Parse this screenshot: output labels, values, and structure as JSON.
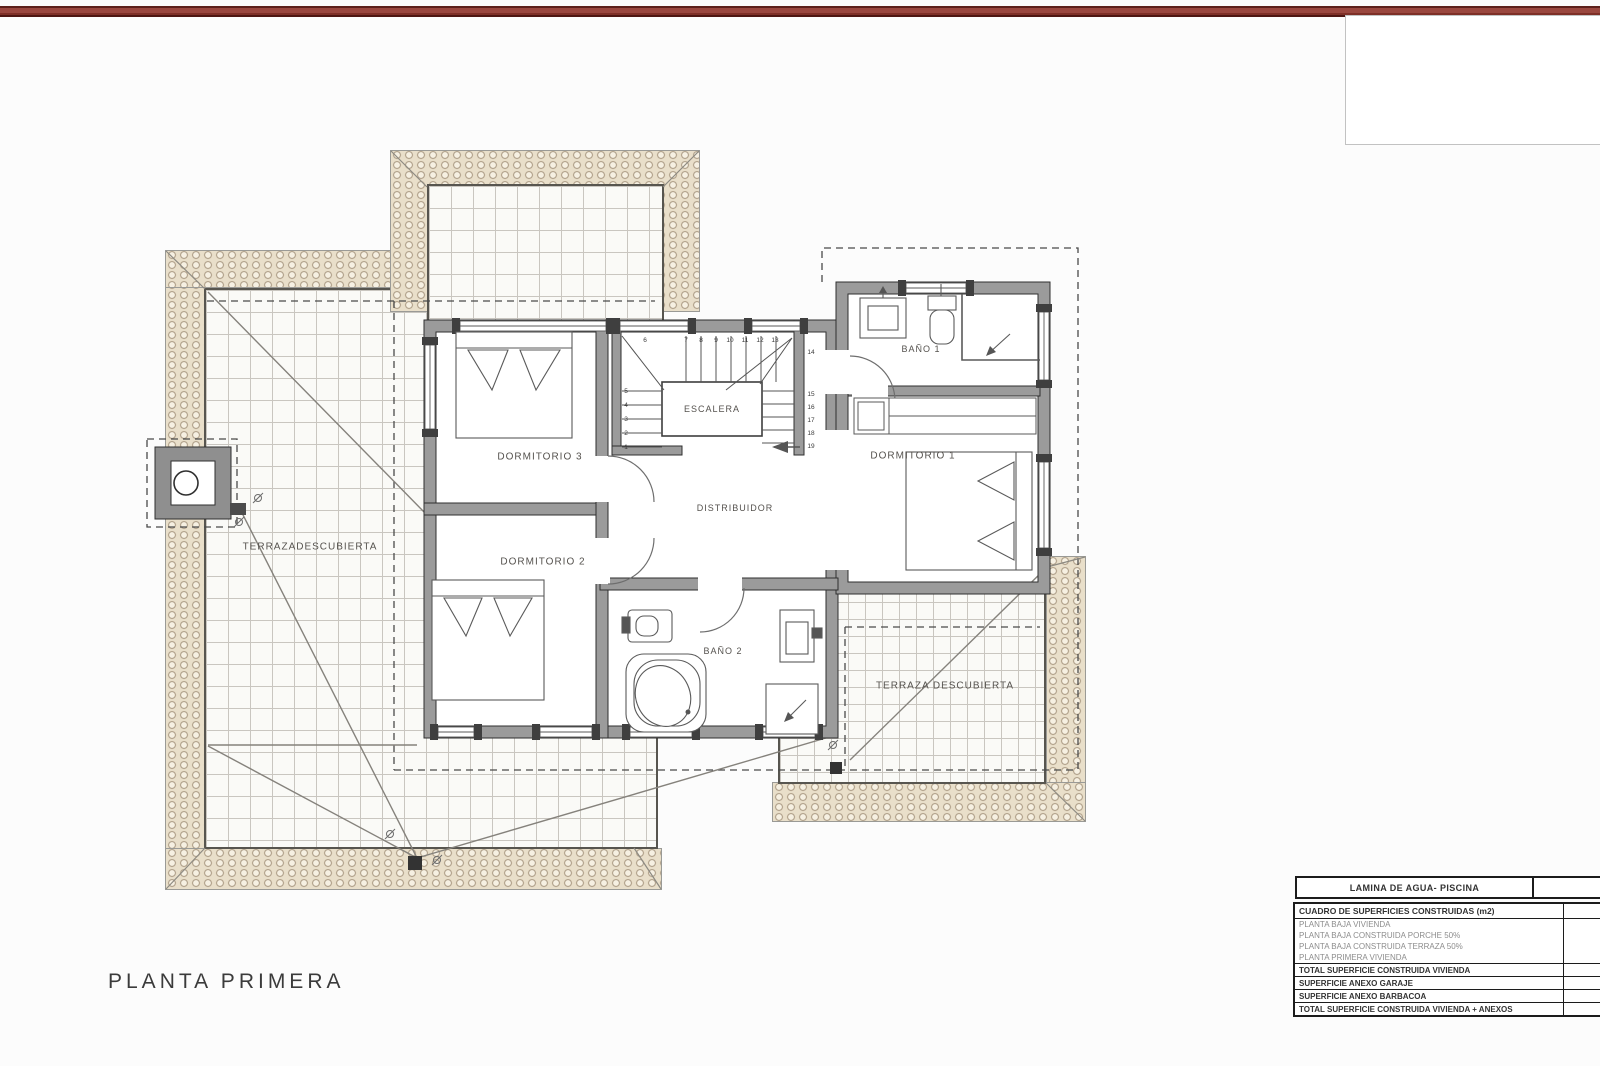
{
  "plan_title": "PLANTA PRIMERA",
  "rooms": {
    "dormitorio1": "DORMITORIO 1",
    "dormitorio2": "DORMITORIO 2",
    "dormitorio3": "DORMITORIO 3",
    "bano1": "BAÑO 1",
    "bano2": "BAÑO 2",
    "escalera": "ESCALERA",
    "distribuidor": "DISTRIBUIDOR",
    "terraza_izquierda": "TERRAZADESCUBIERTA",
    "terraza_derecha": "TERRAZA DESCUBIERTA"
  },
  "stairs": {
    "numbers": [
      {
        "n": "1",
        "x": 626,
        "y": 449
      },
      {
        "n": "2",
        "x": 626,
        "y": 435
      },
      {
        "n": "3",
        "x": 626,
        "y": 421
      },
      {
        "n": "4",
        "x": 626,
        "y": 407
      },
      {
        "n": "5",
        "x": 626,
        "y": 393
      },
      {
        "n": "6",
        "x": 645,
        "y": 342
      },
      {
        "n": "7",
        "x": 686,
        "y": 342
      },
      {
        "n": "8",
        "x": 701,
        "y": 342
      },
      {
        "n": "9",
        "x": 716,
        "y": 342
      },
      {
        "n": "10",
        "x": 730,
        "y": 342
      },
      {
        "n": "11",
        "x": 745,
        "y": 342
      },
      {
        "n": "12",
        "x": 760,
        "y": 342
      },
      {
        "n": "13",
        "x": 775,
        "y": 342
      },
      {
        "n": "14",
        "x": 811,
        "y": 354
      },
      {
        "n": "15",
        "x": 811,
        "y": 396
      },
      {
        "n": "16",
        "x": 811,
        "y": 409
      },
      {
        "n": "17",
        "x": 811,
        "y": 422
      },
      {
        "n": "18",
        "x": 811,
        "y": 435
      },
      {
        "n": "19",
        "x": 811,
        "y": 448
      }
    ]
  },
  "tables": {
    "lamina": {
      "title": "LAMINA DE AGUA- PISCINA",
      "value": ""
    },
    "cuadro": {
      "header": "CUADRO DE SUPERFICIES CONSTRUIDAS (m2)",
      "header_value": "",
      "rows": [
        {
          "label": "PLANTA BAJA VIVIENDA",
          "bold": false,
          "value": ""
        },
        {
          "label": "PLANTA BAJA CONSTRUIDA PORCHE 50%",
          "bold": false,
          "value": ""
        },
        {
          "label": "PLANTA BAJA CONSTRUIDA TERRAZA 50%",
          "bold": false,
          "value": ""
        },
        {
          "label": "PLANTA PRIMERA VIVIENDA",
          "bold": false,
          "value": ""
        },
        {
          "label": "TOTAL SUPERFICIE CONSTRUIDA VIVIENDA",
          "bold": true,
          "value": ""
        },
        {
          "label": "SUPERFICIE ANEXO GARAJE",
          "bold": true,
          "value": ""
        },
        {
          "label": "SUPERFICIE ANEXO BARBACOA",
          "bold": true,
          "value": ""
        },
        {
          "label": "TOTAL SUPERFICIE CONSTRUIDA VIVIENDA + ANEXOS",
          "bold": true,
          "value": ""
        }
      ]
    }
  },
  "colors": {
    "accent_bar": "#8a3b33",
    "roof_tile": "#e9dfca",
    "roof_tile_outline": "#a2917a",
    "grid_line": "#c9c6c0",
    "wall_fill": "#9b9b9b",
    "drawing_line": "#4a4a4a"
  }
}
